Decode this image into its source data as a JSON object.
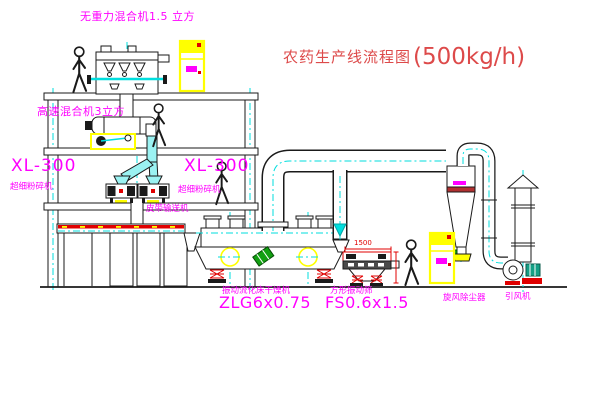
{
  "title": {
    "text": "农药生产线流程图",
    "capacity": "(500kg/h)"
  },
  "labels": {
    "top_mixer": "无重力混合机1.5 立方",
    "high_speed_mixer": "高速混合机3立方",
    "mill_left_model": "XL-300",
    "mill_left_name": "超细粉碎机",
    "mill_center_model": "XL-300",
    "mill_center_name": "超细粉碎机",
    "belt_conveyor": "皮带输送机",
    "dryer_name": "振动流化床干燥机",
    "dryer_model": "ZLG6x0.75",
    "screen_name": "方形振动筛",
    "screen_model": "FS0.6x1.5",
    "cyclone": "旋风除尘器",
    "fan": "引风机",
    "screen_width_dim": "1500"
  },
  "colors": {
    "background": "#ffffff",
    "line_black": "#1a1a1a",
    "centerline_cyan": "#00dede",
    "label_magenta": "#ff00ff",
    "title_red": "#dd4a4a",
    "accent_red": "#e00000",
    "equipment_yellow": "#ffff00",
    "motor_green": "#12a012"
  }
}
